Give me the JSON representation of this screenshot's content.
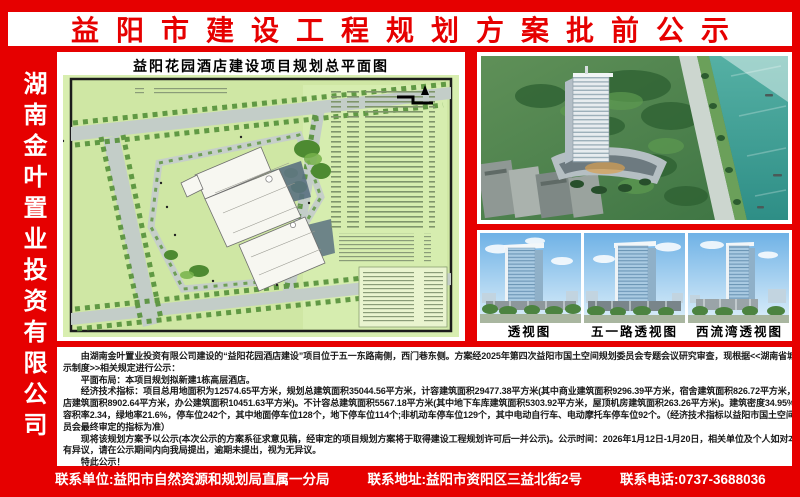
{
  "banner": {
    "title": "益阳市建设工程规划方案批前公示"
  },
  "sidebar": {
    "company_name": "湖南金叶置业投资有限公司"
  },
  "plan": {
    "title": "益阳花园酒店建设项目规划总平面图"
  },
  "renders": {
    "labels": [
      "透视图",
      "五一路透视图",
      "西流湾透视图"
    ]
  },
  "notice": {
    "lines": [
      "　　由湖南金叶置业投资有限公司建设的“益阳花园酒店建设”项目位于五一东路南侧，西门巷东侧。方案经2025年第四次益阳市国土空间规划委员会专题会议研究审查，现根据<<湖南省城市规划公",
      "示制度>>相关规定进行公示：",
      "　　平面布局：本项目规划拟新建1栋高层酒店。",
      "　　经济技术指标：项目总用地面积为12574.65平方米，规划总建筑面积35044.56平方米，计容建筑面积29477.38平方米(其中商业建筑面积9296.39平方米，宿舍建筑面积826.72平方米，酒",
      "店建筑面积8902.64平方米，办公建筑面积10451.63平方米)。不计容总建筑面积5567.18平方米(其中地下车库建筑面积5303.92平方米，屋顶机房建筑面积263.26平方米)。建筑密度34.95%，",
      "容积率2.34，绿地率21.6%，停车位242个，其中地面停车位128个，地下停车位114个;非机动车停车位129个，其中电动自行车、电动摩托车停车位92个。（经济技术指标以益阳市国土空间规划委",
      "员会最终审定的指标为准）",
      "　　现将该规划方案予以公示(本次公示的方案系征求意见稿，经审定的项目规划方案将于取得建设工程规划许可后一并公示)。公示时间：2026年1月12日-1月20日，相关单位及个人如对本规划方案",
      "有异议，请在公示期间内向我局提出，逾期未提出，视为无异议。",
      "　　特此公示！"
    ]
  },
  "footer": {
    "unit": "联系单位:益阳市自然资源和规划局直属一分局",
    "address": "联系地址:益阳市资阳区三益北街2号",
    "phone": "联系电话:0737-3688036"
  },
  "colors": {
    "poster_red": "#e60000",
    "plan_green": "#cfe7a4",
    "water_teal": "#3a9e94",
    "sky_blue": "#79bbe9"
  }
}
